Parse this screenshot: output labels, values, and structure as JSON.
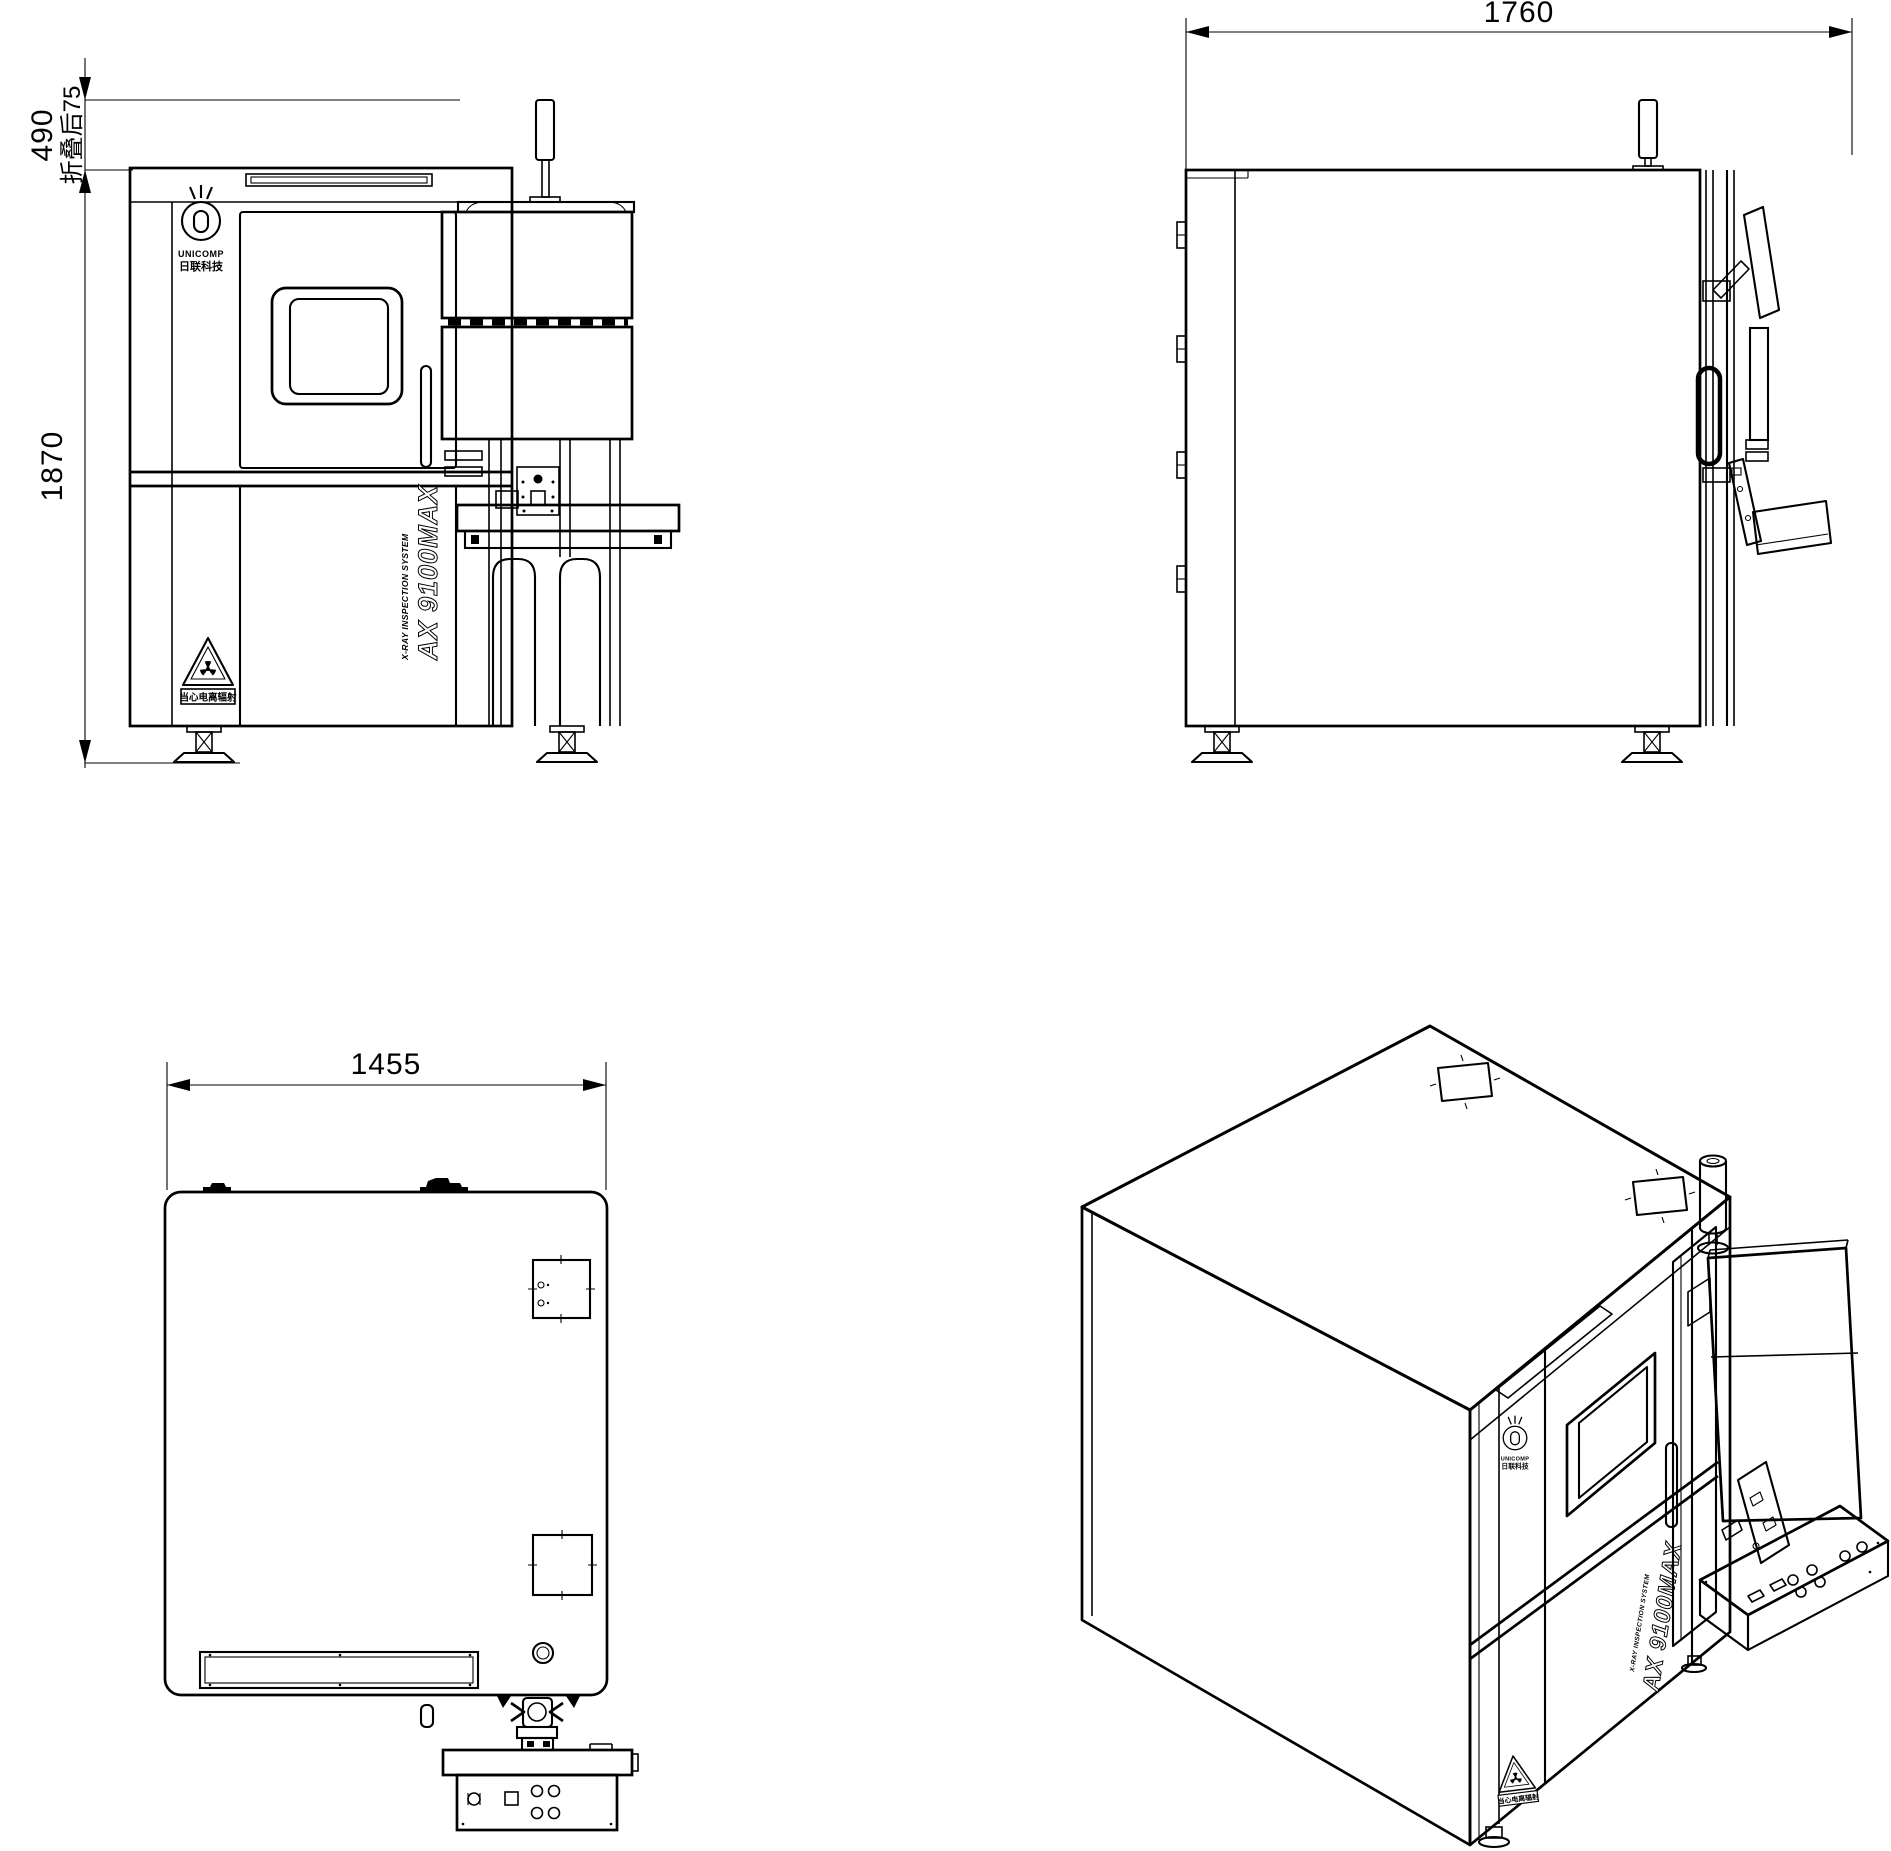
{
  "page": {
    "background": "#ffffff",
    "line_color": "#000000"
  },
  "drawing": {
    "product": {
      "model": "AX 9100MAX",
      "tagline": "X-RAY INSPECTION SYSTEM",
      "brand": "UNICOMP",
      "brand_cn": "日联科技",
      "warning": "当心电离辐射"
    },
    "views": {
      "front": {
        "label": "front view",
        "dim_height_upper": "490",
        "dim_height_upper_note": "折叠后75",
        "dim_height": "1870"
      },
      "side": {
        "label": "side view",
        "dim_depth": "1760"
      },
      "top": {
        "label": "top view",
        "dim_width": "1455"
      },
      "isometric": {
        "label": "isometric view"
      }
    }
  }
}
